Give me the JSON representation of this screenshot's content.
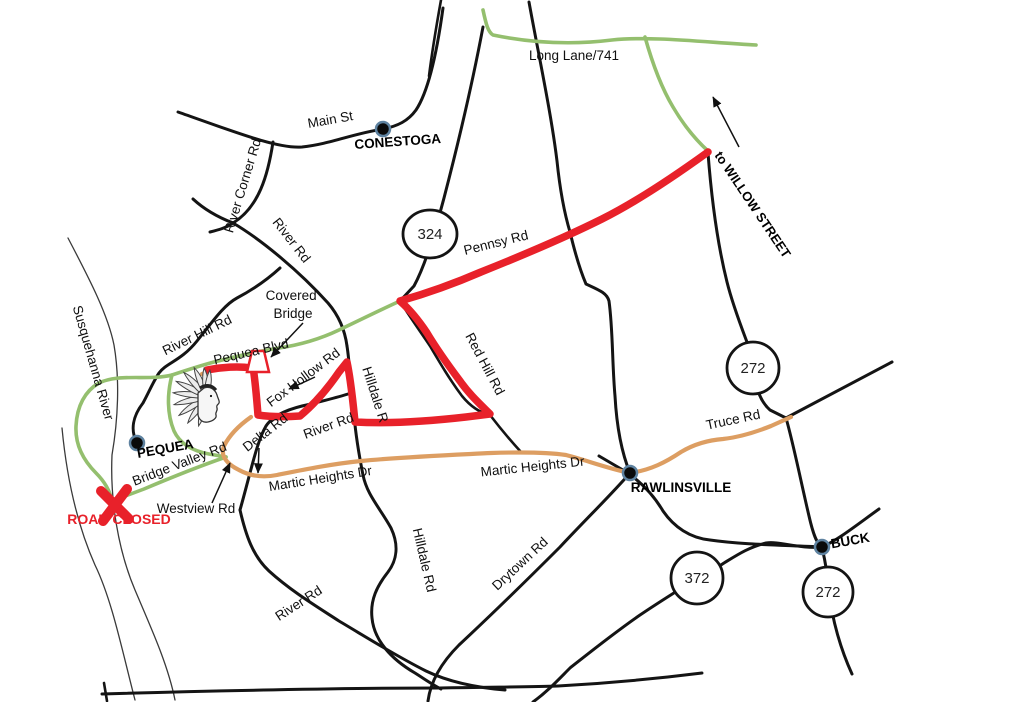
{
  "map": {
    "towns": [
      {
        "name": "CONESTOGA"
      },
      {
        "name": "PEQUEA"
      },
      {
        "name": "RAWLINSVILLE"
      },
      {
        "name": "BUCK"
      }
    ],
    "route_shields": [
      {
        "number": "324"
      },
      {
        "number": "272"
      },
      {
        "number": "372"
      },
      {
        "number": "272"
      }
    ],
    "road_labels": [
      {
        "text": "Main St"
      },
      {
        "text": "River Corner Rd"
      },
      {
        "text": "River Rd"
      },
      {
        "text": "Pennsy Rd"
      },
      {
        "text": "Long Lane/741"
      },
      {
        "text": "River Hill Rd"
      },
      {
        "text": "Pequea Blvd"
      },
      {
        "text": "Fox Hollow Rd"
      },
      {
        "text": "Hilldale R"
      },
      {
        "text": "Red Hill Rd"
      },
      {
        "text": "Truce Rd"
      },
      {
        "text": "Martic Heights Dr"
      },
      {
        "text": "Martic Heights Dr"
      },
      {
        "text": "River Rd"
      },
      {
        "text": "Delta Rd"
      },
      {
        "text": "Bridge Valley Rd"
      },
      {
        "text": "Westview Rd"
      },
      {
        "text": "Hilldale Rd"
      },
      {
        "text": "Drytown Rd"
      },
      {
        "text": "River Rd"
      }
    ],
    "annotations": {
      "river_name": "Susquehanna River",
      "to_willow": "to WILLOW STREET",
      "road_closed": "ROAD CLOSED",
      "covered_bridge_line1": "Covered",
      "covered_bridge_line2": "Bridge"
    },
    "colors": {
      "highlight_route": "#e8212a",
      "scenic_route": "#94bf6e",
      "martic_route": "#dd9e62",
      "road": "#141414",
      "closed": "#e8212a"
    }
  }
}
